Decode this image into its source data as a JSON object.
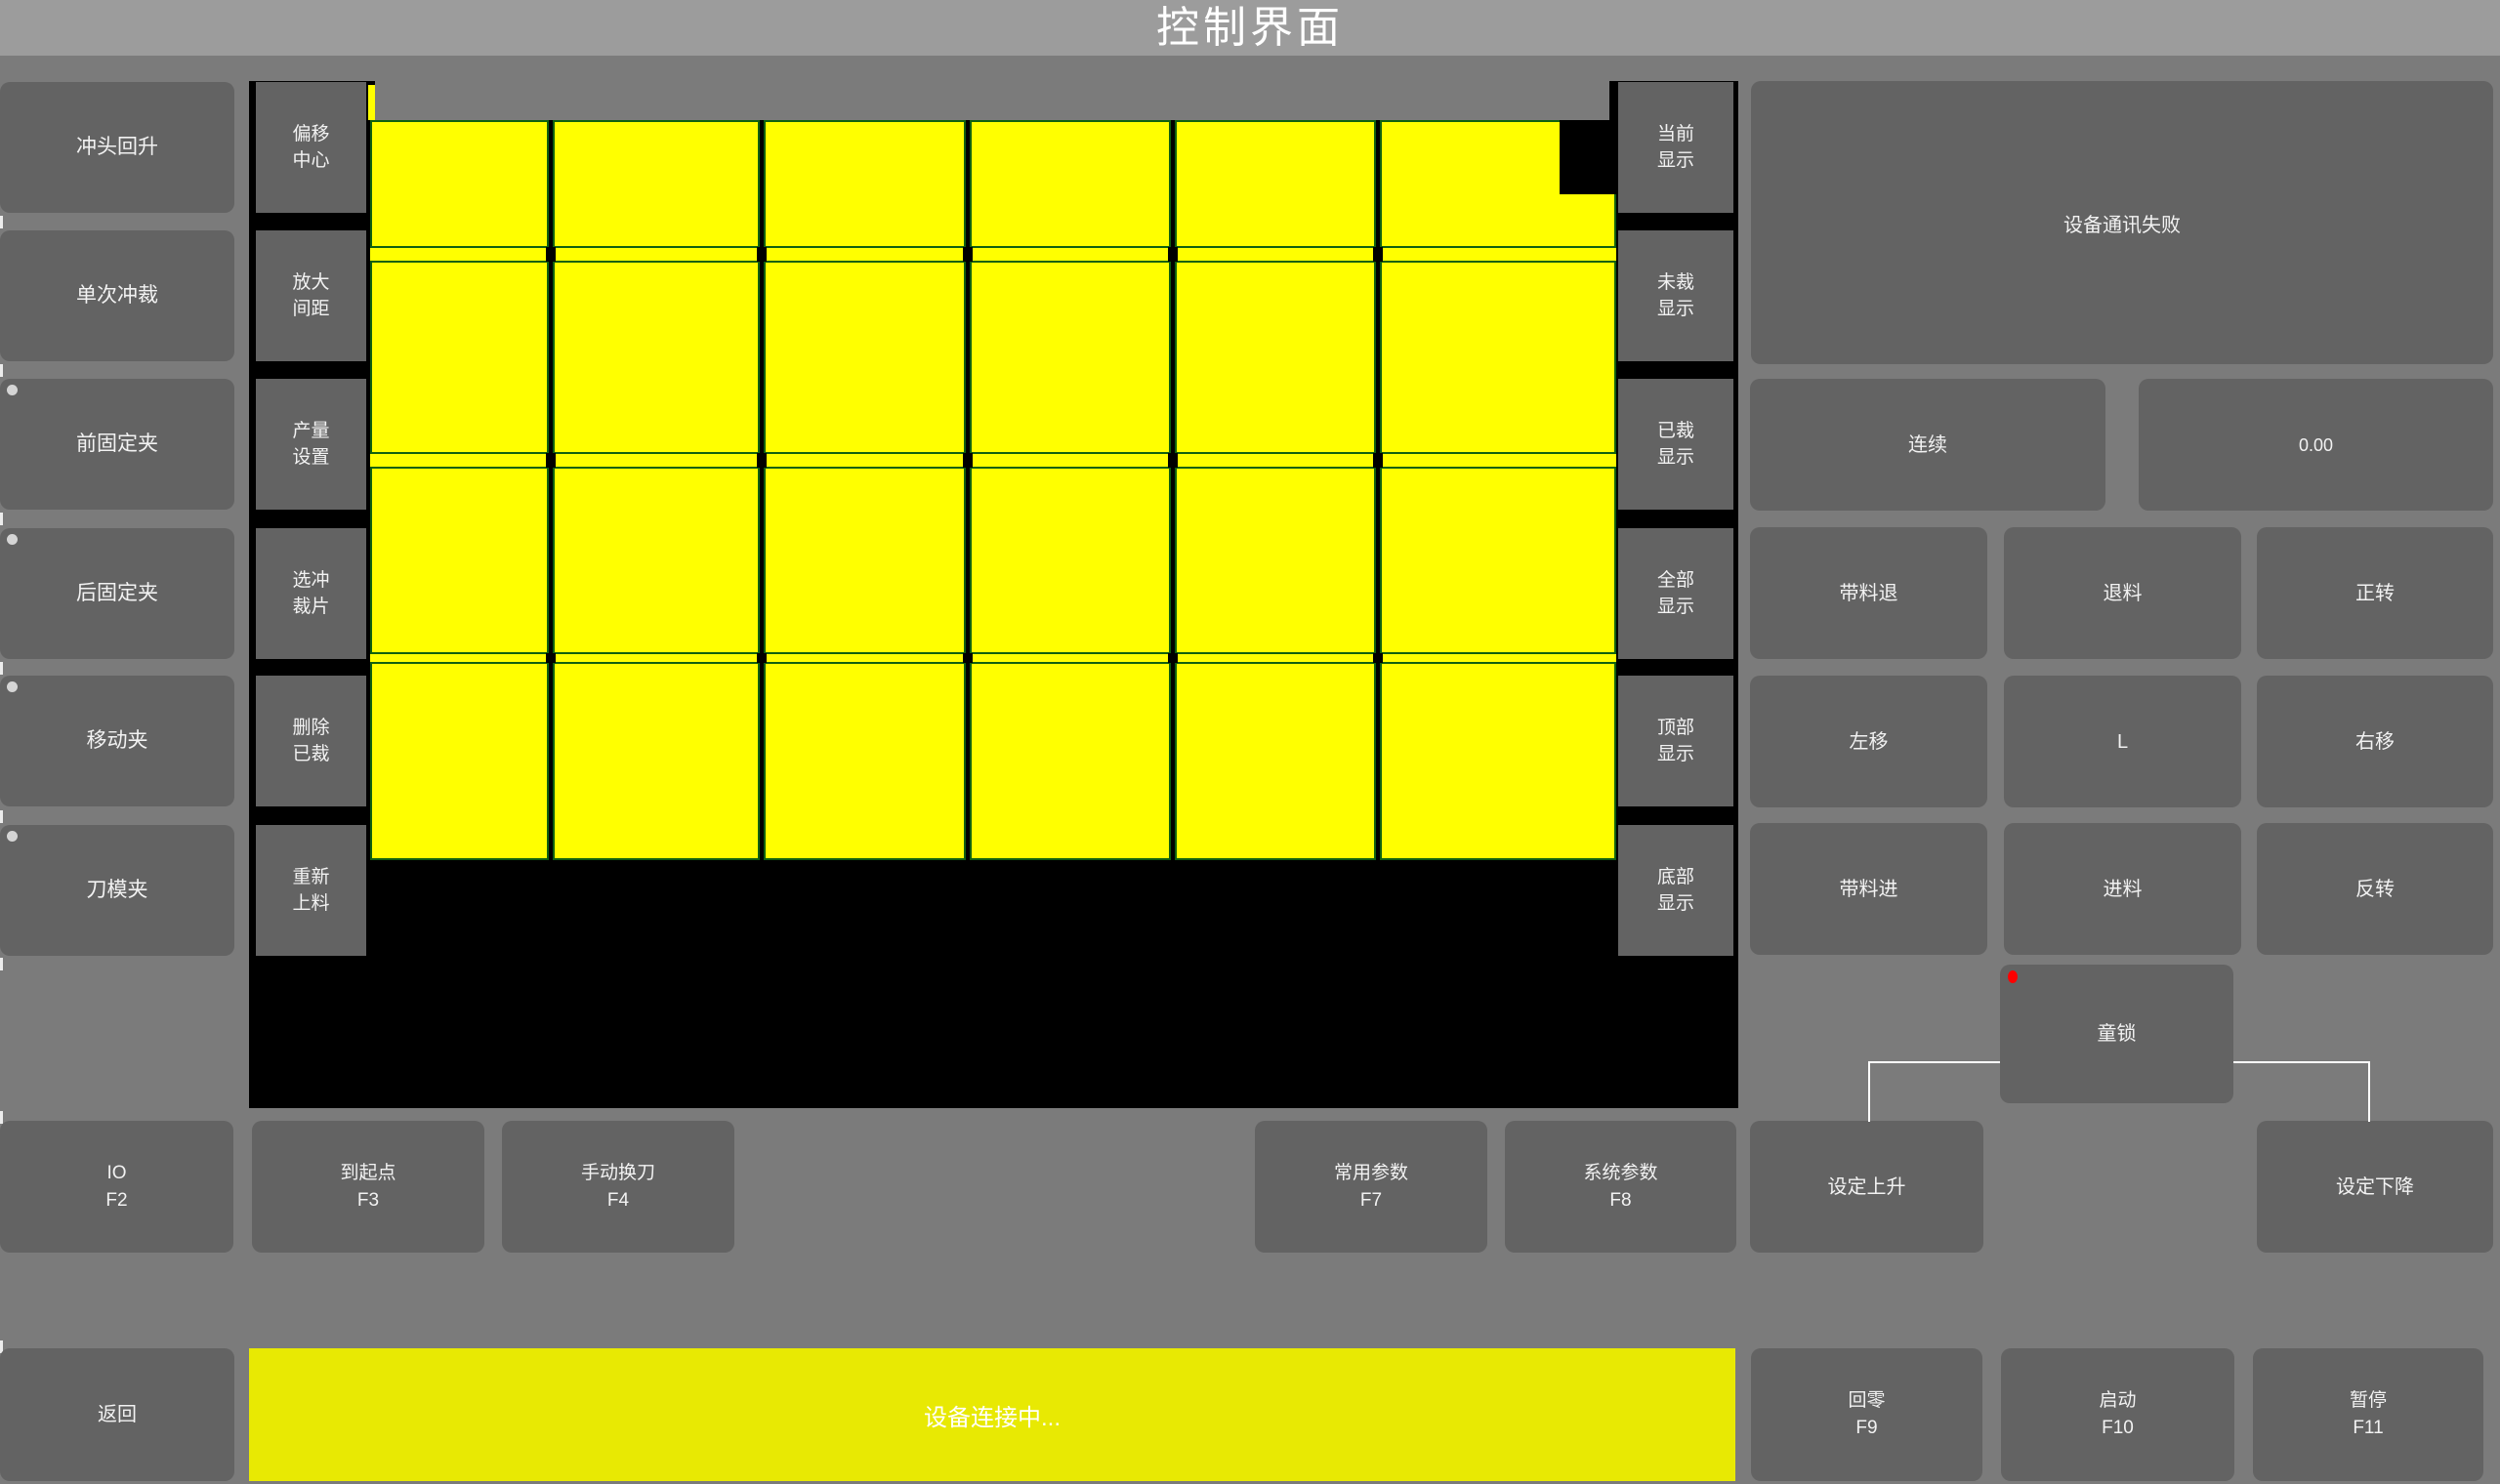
{
  "title": "控制界面",
  "colors": {
    "background": "#7b7b7b",
    "titlebar": "#9c9c9c",
    "button": "#636363",
    "canvas_black": "#000000",
    "piece_yellow": "#ffff00",
    "piece_border_green": "#106010",
    "status_yellow": "#e8e903",
    "indicator_gray": "#d5d5d5",
    "indicator_red": "#ff0000",
    "text_white": "#ffffff"
  },
  "left_column": [
    {
      "label": "冲头回升",
      "dot": false
    },
    {
      "label": "单次冲裁",
      "dot": false
    },
    {
      "label": "前固定夹",
      "dot": true
    },
    {
      "label": "后固定夹",
      "dot": true
    },
    {
      "label": "移动夹",
      "dot": true
    },
    {
      "label": "刀模夹",
      "dot": true
    }
  ],
  "canvas_left_column": [
    "偏移\n中心",
    "放大\n间距",
    "产量\n设置",
    "选冲\n裁片",
    "删除\n已裁",
    "重新\n上料"
  ],
  "canvas_right_column": [
    "当前\n显示",
    "未裁\n显示",
    "已裁\n显示",
    "全部\n显示",
    "顶部\n显示",
    "底部\n显示"
  ],
  "right_panel": {
    "message": "设备通讯失败",
    "continuous": "连续",
    "value": "0.00",
    "jog_rows": [
      [
        "带料退",
        "退料",
        "正转"
      ],
      [
        "左移",
        "L",
        "右移"
      ],
      [
        "带料进",
        "进料",
        "反转"
      ]
    ],
    "child_lock": "童锁"
  },
  "function_row": [
    {
      "label": "IO",
      "fkey": "F2"
    },
    {
      "label": "到起点",
      "fkey": "F3"
    },
    {
      "label": "手动换刀",
      "fkey": "F4"
    },
    {
      "label": "常用参数",
      "fkey": "F7"
    },
    {
      "label": "系统参数",
      "fkey": "F8"
    }
  ],
  "set_rise": "设定上升",
  "set_fall": "设定下降",
  "bottom_bar": {
    "back": "返回",
    "status": "设备连接中...",
    "buttons": [
      {
        "label": "回零",
        "fkey": "F9"
      },
      {
        "label": "启动",
        "fkey": "F10"
      },
      {
        "label": "暂停",
        "fkey": "F11"
      }
    ]
  },
  "grid": {
    "rows": 4,
    "cols": 6,
    "x_bounds": [
      377,
      564,
      780,
      991,
      1201,
      1411,
      1657
    ],
    "row_bounds": [
      [
        123,
        254
      ],
      [
        267,
        465
      ],
      [
        478,
        670
      ],
      [
        678,
        881
      ]
    ],
    "notch": [
      1597,
      123,
      60,
      76
    ],
    "sliver": [
      377,
      87,
      7,
      36
    ],
    "cover": [
      384,
      83,
      1264,
      40
    ]
  }
}
